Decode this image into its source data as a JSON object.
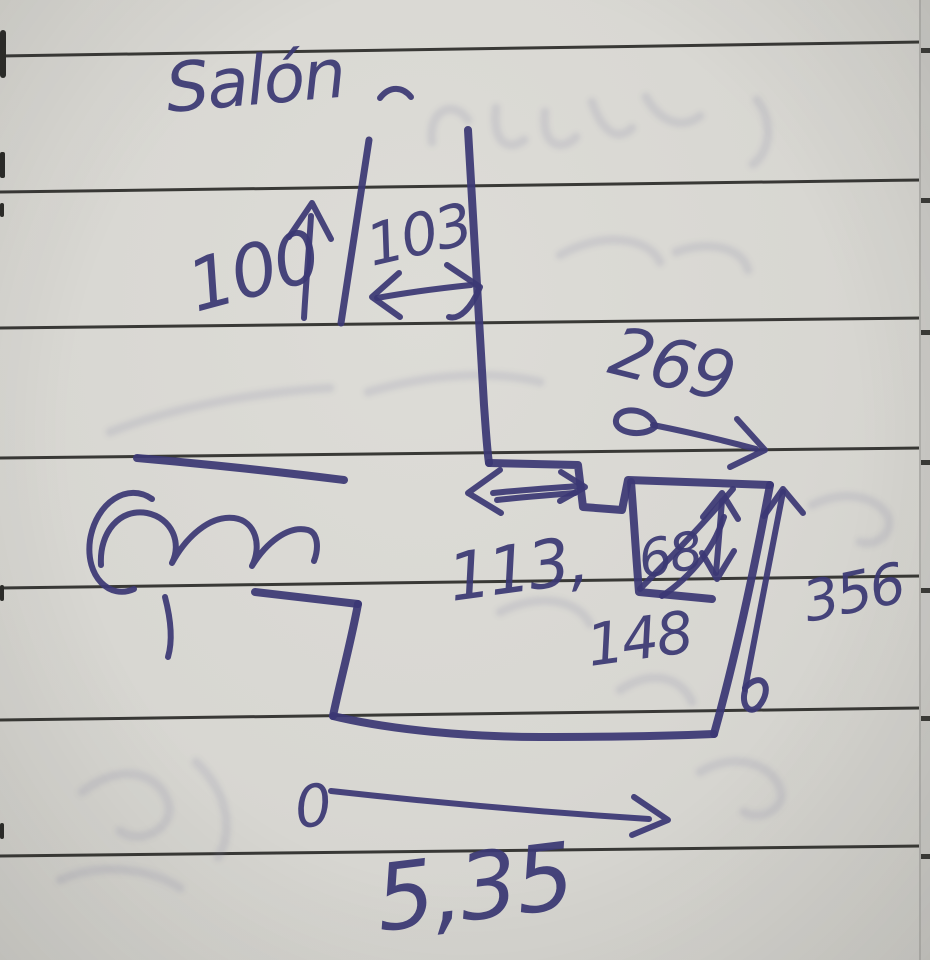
{
  "sketch": {
    "title": "Salón",
    "dimensions": {
      "d100": "100",
      "d103": "103",
      "d269": "269",
      "d113": "113,",
      "d68": "68",
      "d148": "148",
      "d356": "356",
      "origin": "0",
      "total": "5,35"
    }
  },
  "colors": {
    "paper": "#d8d7d2",
    "ruled_line": "#222220",
    "ink": "#3b3874",
    "ghost": "#7d7d9c"
  }
}
